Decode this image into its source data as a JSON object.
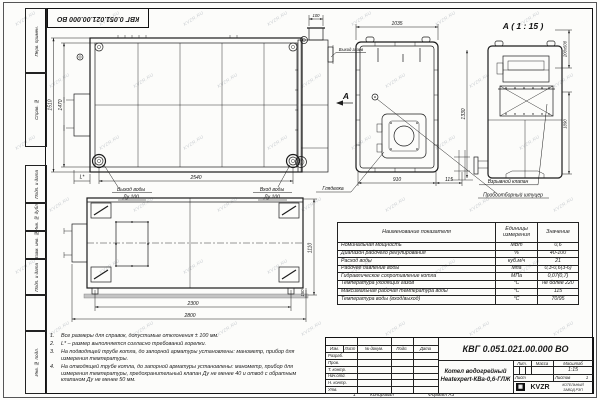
{
  "watermark": "KVZR.RU",
  "frame": {
    "side_fields": [
      "Перв. примен.",
      "Справ. №",
      "Подп. и дата",
      "Инв. № дубл.",
      "Взам. инв. №",
      "Подп. и дата",
      "Инв. № подл."
    ]
  },
  "title_block": {
    "doc_number": "КВГ 0.051.021.00.000 ВО",
    "product_line1": "Котел водогрейный",
    "product_line2": "Heatexpert-КВа-0,6-ГЛЖ",
    "header_cols": [
      "Изм.",
      "Лист",
      "№ докум.",
      "Подп.",
      "Дата"
    ],
    "sign_rows": [
      "Разраб.",
      "Пров.",
      "Т. контр.",
      "Нач.отд.",
      "Н. контр.",
      "Утв."
    ],
    "lit_label": "Лит.",
    "mass_label": "Масса",
    "scale_label": "Масштаб",
    "scale_value": "1:15",
    "sheet_label": "Лист",
    "sheets_label": "Листов",
    "sheets_value": "1",
    "company": {
      "logo": "KVZR",
      "line1": "КОТЕЛЬНЫЙ",
      "line2": "ЗАВОД РЭП"
    },
    "sheet_mark": "1",
    "copied_label": "Копировал",
    "format_label": "Формат А3"
  },
  "params_table": {
    "headers": [
      "Наименование показателя",
      "Единицы измерения",
      "Значение"
    ],
    "rows": [
      {
        "name": "Номинальная мощность",
        "unit": "МВт",
        "value": "0,6"
      },
      {
        "name": "Диапазон рабочего регулирования",
        "unit": "%",
        "value": "40-100"
      },
      {
        "name": "Расход воды",
        "unit": "куб.м/ч",
        "value": "21"
      },
      {
        "name": "Рабочее давление воды",
        "unit": "Мпа",
        "value": "0,3-0,6(3-6)"
      },
      {
        "name": "Гидравлическое сопротивление котла",
        "unit": "МПа",
        "value": "0,07(0,7)"
      },
      {
        "name": "Температура уходящих газов",
        "unit": "°С",
        "value": "не более 220"
      },
      {
        "name": "Максимальная рабочая температура воды",
        "unit": "°С",
        "value": "115"
      },
      {
        "name": "Температура воды (вход/выход)",
        "unit": "°С",
        "value": "70/95"
      }
    ]
  },
  "notes": {
    "items": [
      {
        "num": "1.",
        "text": "Все размеры для справок, допустимые отклонения ± 100 мм."
      },
      {
        "num": "2.",
        "text": "L* – размер выполняется согласно требований горелки."
      },
      {
        "num": "3.",
        "text": "На подводящей трубе котла, до запорной арматуры установлены: манометр, прибор для измерения температуры."
      },
      {
        "num": "4.",
        "text": "На отводящей трубе котла, до запорной арматуры установлены: манометр, прибор для измерения температуры, предохранительный клапан Ду не менее 40 и отвод с обратным клапаном Ду не менее  50 мм."
      }
    ]
  },
  "views": {
    "section_title": "А ( 1 : 15 )",
    "arrow_label": "А",
    "labels": {
      "water_out_1": "Выход воды",
      "water_out_2": "Ду 100",
      "water_in_1": "Вход воды",
      "water_in_2": "Ду 100",
      "gas_out": "Выход газов",
      "sight_glass": "Гляделка",
      "explosion_valve": "Взрывной клапан",
      "sampling_fitting": "Пробоотборный штуцер"
    },
    "dims": {
      "plan_h_outer": "1510",
      "plan_h_inner": "1470",
      "plan_w": "2540",
      "burner": "L*",
      "flue_w": "100",
      "front_w_top": "1035",
      "front_w_bot": "910",
      "front_off": "115",
      "sec_h_left": "1330",
      "sec_duct": "200х500",
      "sec_h_right": "1090",
      "side_w_inner": "2300",
      "side_w_outer": "2800",
      "side_h": "1110",
      "leg": "150"
    }
  }
}
